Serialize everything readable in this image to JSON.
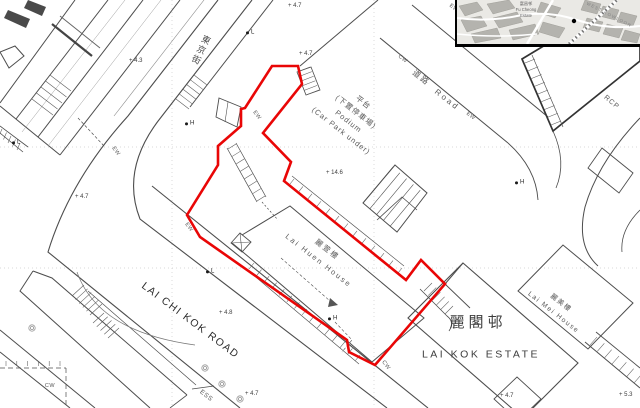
{
  "map": {
    "colors": {
      "boundary_red": "#e90606",
      "line_gray": "#4d4d4d",
      "light_gray": "#8a8a8a",
      "grid_dot": "#cccccc",
      "dark_fill": "#4a4a4a",
      "tree": "#999999"
    },
    "site_boundary": {
      "width": 2.6,
      "points": [
        [
          272,
          66
        ],
        [
          298,
          66
        ],
        [
          302,
          84
        ],
        [
          263,
          133
        ],
        [
          291,
          162
        ],
        [
          284,
          181
        ],
        [
          406,
          280
        ],
        [
          421,
          260
        ],
        [
          445,
          284
        ],
        [
          375,
          365
        ],
        [
          349,
          352
        ],
        [
          347,
          340
        ],
        [
          200,
          237
        ],
        [
          187,
          215
        ],
        [
          218,
          165
        ],
        [
          218,
          146
        ],
        [
          241,
          126
        ],
        [
          241,
          109
        ],
        [
          245,
          108
        ]
      ]
    },
    "labels": [
      {
        "id": "tonkin-street",
        "text": "東京街",
        "x": 200,
        "y": 50,
        "rot": 26,
        "size": 9,
        "ls": 2,
        "color": "#4a4a4a",
        "vertical": true
      },
      {
        "id": "podium",
        "lines": [
          "平台",
          "(下置停車場)",
          "Podium",
          "(Car Park under)"
        ],
        "x": 352,
        "y": 117,
        "rot": 38,
        "size": 7.5,
        "ls": 1,
        "lh": 1.6,
        "color": "#5a5a5a"
      },
      {
        "id": "road-cn",
        "text": "道路",
        "x": 421,
        "y": 78,
        "rot": 38,
        "size": 8,
        "ls": 2,
        "color": "#5a5a5a"
      },
      {
        "id": "road-en",
        "text": "Road",
        "x": 447,
        "y": 100,
        "rot": 38,
        "size": 8,
        "ls": 2.5,
        "color": "#5a5a5a"
      },
      {
        "id": "lai-huen-house",
        "lines": [
          "麗萱樓",
          "Lai Huen House"
        ],
        "x": 323,
        "y": 255,
        "rot": 38,
        "size": 7.5,
        "ls": 2,
        "lh": 1.8,
        "color": "#5a5a5a"
      },
      {
        "id": "lai-kok-estate-cn",
        "text": "麗閣邨",
        "x": 478,
        "y": 323,
        "rot": 0,
        "size": 15,
        "ls": 4,
        "color": "#3d3d3d"
      },
      {
        "id": "lai-kok-estate-en",
        "text": "LAI KOK ESTATE",
        "x": 481,
        "y": 355,
        "rot": 0,
        "size": 10.5,
        "ls": 2.5,
        "color": "#3d3d3d"
      },
      {
        "id": "lai-mei-house",
        "lines": [
          "麗美樓",
          "Lai Mei House"
        ],
        "x": 557,
        "y": 308,
        "rot": 38,
        "size": 6.8,
        "ls": 1.5,
        "lh": 1.7,
        "color": "#5a5a5a"
      },
      {
        "id": "lai-chi-kok-road",
        "text": "LAI CHI KOK ROAD",
        "x": 190,
        "y": 321,
        "rot": 37,
        "size": 10.5,
        "ls": 1.5,
        "color": "#2e2e2e"
      },
      {
        "id": "rcp",
        "text": "RCP",
        "x": 611,
        "y": 103,
        "rot": 40,
        "size": 7,
        "ls": 1,
        "color": "#5a5a5a"
      },
      {
        "id": "ess",
        "text": "ESS",
        "x": 206,
        "y": 396,
        "rot": 38,
        "size": 6.5,
        "ls": 0.5,
        "color": "#5a5a5a"
      },
      {
        "id": "ew-1",
        "text": "EW",
        "x": 115,
        "y": 152,
        "rot": 52,
        "size": 5.5,
        "ls": 0.5,
        "color": "#555555"
      },
      {
        "id": "ew-2",
        "text": "EW",
        "x": 256,
        "y": 116,
        "rot": 52,
        "size": 5.5,
        "ls": 0.5,
        "color": "#555555"
      },
      {
        "id": "ew-3",
        "text": "EW",
        "x": 188,
        "y": 228,
        "rot": 52,
        "size": 5.5,
        "ls": 0.5,
        "color": "#555555"
      },
      {
        "id": "ew-4",
        "text": "EW",
        "x": 470,
        "y": 117,
        "rot": 38,
        "size": 5.5,
        "ls": 0.5,
        "color": "#555555"
      },
      {
        "id": "ew-5",
        "text": "EW",
        "x": 453,
        "y": 9,
        "rot": 38,
        "size": 5.5,
        "ls": 0.5,
        "color": "#555555"
      },
      {
        "id": "cw-1",
        "text": "CW",
        "x": 402,
        "y": 60,
        "rot": 38,
        "size": 5.5,
        "ls": 0.5,
        "color": "#555555"
      },
      {
        "id": "cw-2",
        "text": "CW",
        "x": 385,
        "y": 366,
        "rot": 52,
        "size": 5.5,
        "ls": 0.5,
        "color": "#555555"
      },
      {
        "id": "cw-3",
        "text": "CW",
        "x": 50,
        "y": 387,
        "rot": 0,
        "size": 5.5,
        "ls": 0.5,
        "color": "#555555"
      }
    ],
    "spot_heights": [
      {
        "value": "4.3",
        "x": 136,
        "y": 61
      },
      {
        "value": "4.7",
        "x": 295,
        "y": 6
      },
      {
        "value": "4.7",
        "x": 306,
        "y": 54
      },
      {
        "value": "4.7",
        "x": 82,
        "y": 197
      },
      {
        "value": "14.6",
        "x": 333,
        "y": 173
      },
      {
        "value": "4.8",
        "x": 226,
        "y": 313
      },
      {
        "value": "4.7",
        "x": 252,
        "y": 394
      },
      {
        "value": "4.7",
        "x": 507,
        "y": 396
      },
      {
        "value": "5.3",
        "x": 626,
        "y": 395
      }
    ],
    "survey_markers": [
      {
        "letter": "H",
        "x": 187,
        "y": 124
      },
      {
        "letter": "H",
        "x": 517,
        "y": 183
      },
      {
        "letter": "H",
        "x": 330,
        "y": 319
      },
      {
        "letter": "L",
        "x": 248,
        "y": 33
      },
      {
        "letter": "L",
        "x": 14,
        "y": 143
      },
      {
        "letter": "L",
        "x": 208,
        "y": 272
      }
    ],
    "trees": [
      [
        32,
        328
      ],
      [
        205,
        368
      ],
      [
        222,
        384
      ],
      [
        240,
        399
      ]
    ]
  },
  "inset": {
    "labels": [
      {
        "id": "fu-cheong-estate",
        "lines": [
          "富昌邨",
          "Fu Cheong",
          "Estate"
        ],
        "x": 69,
        "y": 10,
        "rot": 0,
        "size": 4.2,
        "ls": 0,
        "color": "#5f5f5f"
      },
      {
        "id": "west-kowloon",
        "text": "WEST KOWLOON",
        "x": 152,
        "y": 15,
        "rot": 27,
        "size": 4.3,
        "ls": 1.2,
        "color": "#848484"
      }
    ]
  }
}
